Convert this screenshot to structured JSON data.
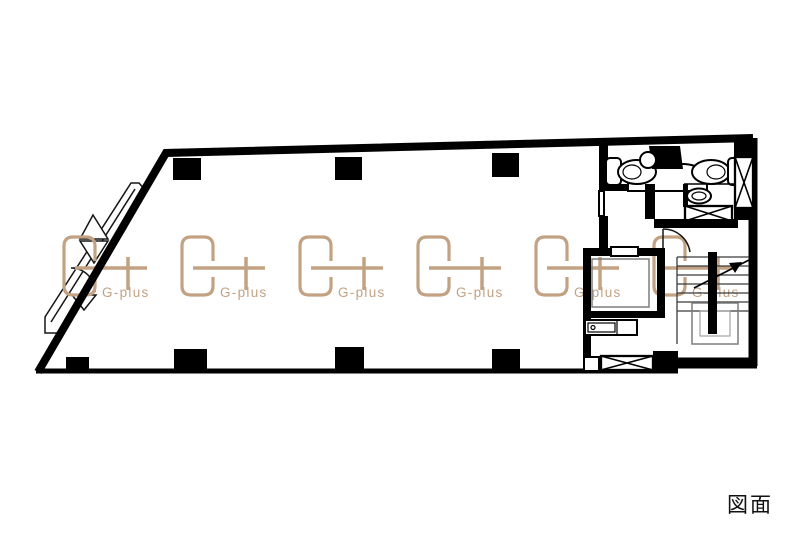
{
  "drawing": {
    "type_label": "図面"
  },
  "watermark": {
    "label": "G-plus",
    "color": "#c2a283",
    "count": 6
  },
  "palette": {
    "background": "#ffffff",
    "wall": "#000000",
    "stair_tread": "#3a3a3a",
    "stair_guide": "#7d7d7d"
  }
}
